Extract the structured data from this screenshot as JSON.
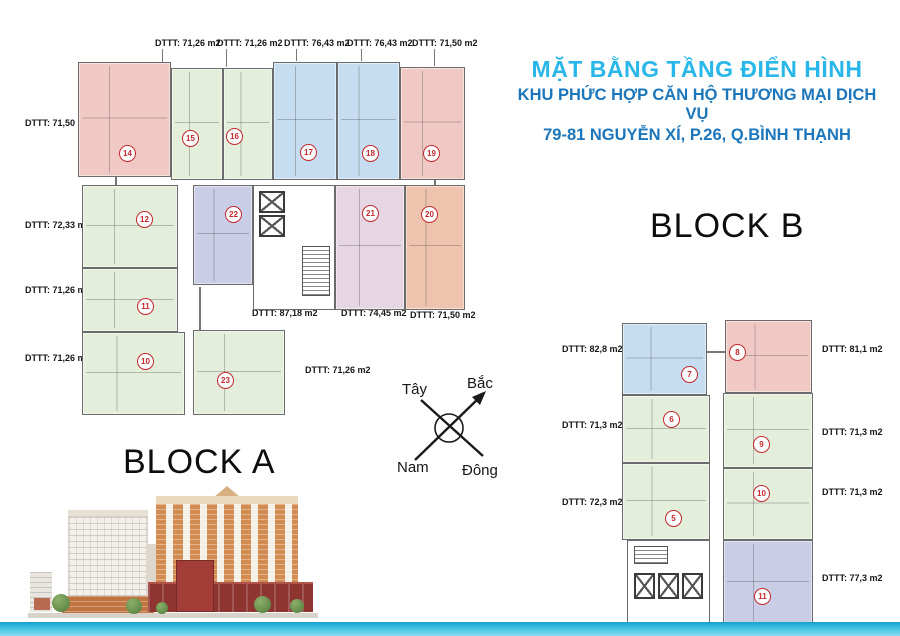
{
  "header": {
    "title": "MẶT BẰNG TẦNG ĐIỂN HÌNH",
    "subtitle1": "KHU PHỨC HỢP CĂN HỘ THƯƠNG MẠI DỊCH VỤ",
    "subtitle2": "79-81 NGUYỄN XÍ, P.26, Q.BÌNH THẠNH"
  },
  "compass": {
    "west": "Tây",
    "north": "Bắc",
    "south": "Nam",
    "east": "Đông"
  },
  "block_a": {
    "title": "BLOCK A",
    "top_labels": [
      "DTTT: 71,26 m2",
      "DTTT: 71,26 m2",
      "DTTT: 76,43 m2",
      "DTTT: 76,43 m2",
      "DTTT: 71,50 m2"
    ],
    "left_labels": [
      "DTTT: 71,50 m2",
      "DTTT: 72,33 m2",
      "DTTT: 71,26 m2",
      "DTTT: 71,26 m2"
    ],
    "mid_labels": [
      "DTTT: 87,18 m2",
      "DTTT: 74,45 m2",
      "DTTT: 71,50 m2",
      "DTTT: 71,26 m2"
    ],
    "units": {
      "u14": "14",
      "u15": "15",
      "u16": "16",
      "u17": "17",
      "u18": "18",
      "u19": "19",
      "u12": "12",
      "u22": "22",
      "u21": "21",
      "u20": "20",
      "u11": "11",
      "u10": "10",
      "u23": "23"
    }
  },
  "block_b": {
    "title": "BLOCK B",
    "left_labels": [
      "DTTT: 82,8 m2",
      "DTTT: 71,3 m2",
      "DTTT: 72,3 m2"
    ],
    "right_labels": [
      "DTTT: 81,1 m2",
      "DTTT: 71,3 m2",
      "DTTT: 71,3 m2",
      "DTTT: 77,3 m2"
    ],
    "units": {
      "u7": "7",
      "u8": "8",
      "u6": "6",
      "u9": "9",
      "u5": "5",
      "u10": "10",
      "u11": "11"
    }
  },
  "colors": {
    "title_cyan": "#29b6e8",
    "title_blue": "#1b76bb",
    "unit_green": "#e3eedb",
    "unit_pink": "#f0c9c5",
    "unit_blue": "#c6dcf0",
    "unit_lavender": "#c9cde5",
    "unit_purple": "#e6d5e3",
    "unit_salmon": "#eec4af",
    "badge_red": "#c4272c",
    "footer_cyan": "#3fc0e3"
  }
}
